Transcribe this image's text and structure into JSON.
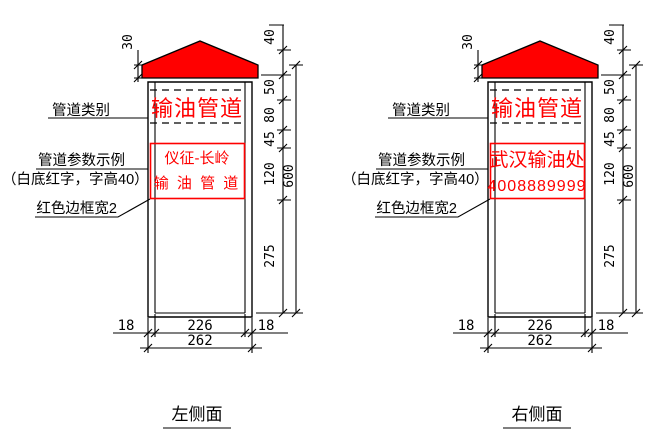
{
  "drawing": {
    "background": "#ffffff",
    "line_color": "#000000",
    "accent_red": "#ff0000"
  },
  "views": [
    {
      "title": "左侧面",
      "callouts": {
        "category": "管道类别",
        "params": "管道参数示例",
        "params_note": "（白底红字，字高40）",
        "border": "红色边框宽2"
      },
      "sign": {
        "category_text": "输油管道",
        "panel_line1": "仪征-长岭",
        "panel_line2": "输 油 管 道"
      },
      "dims": {
        "cap_height": "30",
        "seg1": "40",
        "seg2": "50",
        "seg3": "80",
        "seg4": "45",
        "seg5": "120",
        "overall_height": "600",
        "lower_height": "275",
        "left_inset": "18",
        "inner_width": "226",
        "right_inset": "18",
        "total_width": "262"
      }
    },
    {
      "title": "右侧面",
      "callouts": {
        "category": "管道类别",
        "params": "管道参数示例",
        "params_note": "（白底红字，字高40）",
        "border": "红色边框宽2"
      },
      "sign": {
        "category_text": "输油管道",
        "panel_line1": "武汉输油处",
        "panel_line2": "4008889999"
      },
      "dims": {
        "cap_height": "30",
        "seg1": "40",
        "seg2": "50",
        "seg3": "80",
        "seg4": "45",
        "seg5": "120",
        "overall_height": "600",
        "lower_height": "275",
        "left_inset": "18",
        "inner_width": "226",
        "right_inset": "18",
        "total_width": "262"
      }
    }
  ]
}
